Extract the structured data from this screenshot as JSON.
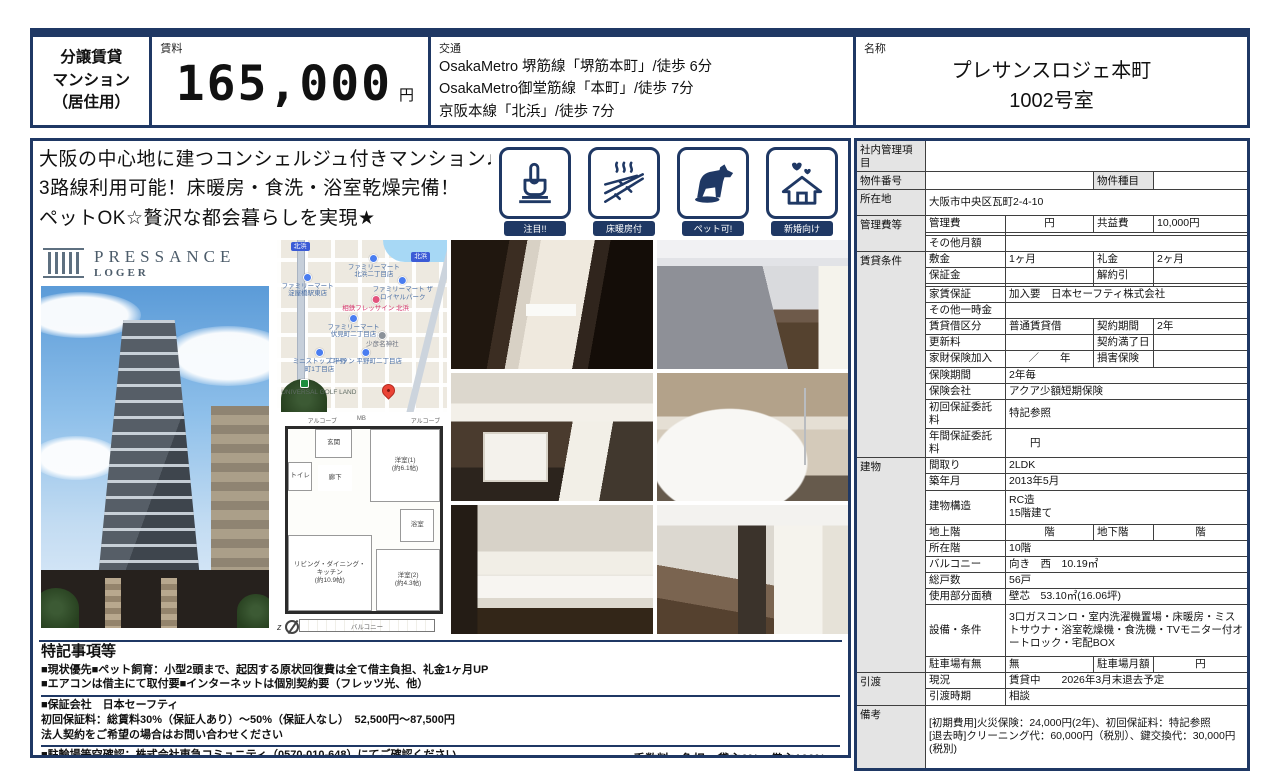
{
  "colors": {
    "navy": "#1f3864",
    "label_bg": "#e4e4e4",
    "pin_red": "#ea4335",
    "poi_blue": "#4a7df0"
  },
  "header": {
    "property_type_lines": [
      "分譲賃貸",
      "マンション",
      "（居住用）"
    ],
    "rent_label": "賃料",
    "rent_value": "165,000",
    "rent_unit": "円",
    "transit_label": "交通",
    "transit_lines": [
      "OsakaMetro 堺筋線「堺筋本町」/徒歩 6分",
      "OsakaMetro御堂筋線「本町」/徒歩 7分",
      "京阪本線「北浜」/徒歩 7分"
    ],
    "name_label": "名称",
    "name_lines": [
      "プレサンスロジェ本町",
      "1002号室"
    ]
  },
  "catch_copy_lines": [
    "大阪の中心地に建つコンシェルジュ付きマンション♪",
    "3路線利用可能！床暖房・食洗・浴室乾燥完備！",
    "ペットOK☆贅沢な都会暮らしを実現★"
  ],
  "features": {
    "items": [
      {
        "label": "注目!!"
      },
      {
        "label": "床暖房付"
      },
      {
        "label": "ペット可!"
      },
      {
        "label": "新婚向け"
      }
    ]
  },
  "logo": {
    "brand": "PRESSANCE",
    "sub": "LOGER"
  },
  "map": {
    "station_labels": [
      "北浜",
      "北浜"
    ],
    "pois": [
      {
        "n": "ファミリーマート\n北浜二丁目店",
        "x": 57,
        "y": 8,
        "c": "blue"
      },
      {
        "n": "ファミリーマート\n淀屋橋駅東店",
        "x": 18,
        "y": 19,
        "c": "blue"
      },
      {
        "n": "ファミリーマート ザ\nロイヤルパーク",
        "x": 74,
        "y": 21,
        "c": "blue"
      },
      {
        "n": "相鉄フレッサイン 北浜",
        "x": 58,
        "y": 32,
        "c": "pink"
      },
      {
        "n": "ファミリーマート\n伏見町二丁目店",
        "x": 45,
        "y": 43,
        "c": "blue"
      },
      {
        "n": "少彦名神社",
        "x": 62,
        "y": 53,
        "c": "gray"
      },
      {
        "n": "ミニストップ 平野\n町1丁目店",
        "x": 25,
        "y": 63,
        "c": "blue"
      },
      {
        "n": "ローソン 平野町二丁目店",
        "x": 52,
        "y": 63,
        "c": "blue"
      },
      {
        "n": "UNIVERSAL GOLF LAND",
        "x": 16,
        "y": 81,
        "c": "green"
      }
    ]
  },
  "floorplan": {
    "alcove_left": "アルコーブ",
    "mb": "MB",
    "alcove_right": "アルコーブ",
    "entrance": "玄関",
    "hall": "廊下",
    "toilet": "トイレ",
    "bath": "浴室",
    "room1": "洋室(1)",
    "room1_size": "(約6.1帖)",
    "ldk": "リビング・ダイニング・キッチン",
    "ldk_size": "(約10.9帖)",
    "room2": "洋室(2)",
    "room2_size": "(約4.3帖)",
    "balcony": "バルコニー",
    "compass": "z"
  },
  "notes": {
    "title": "特記事項等",
    "block1": [
      "■現状優先■ペット飼育：小型2頭まで、起因する原状回復費は全て借主負担、礼金1ヶ月UP",
      "■エアコンは借主にて取付要■インターネットは個別契約要（フレッツ光、他）"
    ],
    "block2": [
      "■保証会社　日本セーフティ",
      "初回保証料：総賃料30%（保証人あり）～50%（保証人なし）　52,500円～87,500円",
      "法人契約をご希望の場合はお問い合わせください"
    ],
    "block3": [
      "■駐輪場等空確認：株式会社東急コミュニティ（0570-010-648）にてご確認ください",
      "■短期解約違約金：半年以内　総賃料2ヶ月、1年以内　総賃料1ヶ月"
    ],
    "fees": [
      "■手数料　負担：貸主0%　借主100%",
      "分配：元付0%　客付100%"
    ]
  },
  "table": {
    "rows": [
      {
        "cells": [
          {
            "t": "社内管理項目",
            "k": "g"
          },
          {
            "t": "",
            "c": 4
          }
        ]
      },
      {
        "cells": [
          {
            "t": "物件番号",
            "k": "g"
          },
          {
            "t": "",
            "c": 2
          },
          {
            "t": "物件種目",
            "k": "g"
          },
          {
            "t": ""
          }
        ]
      },
      {
        "h": 26,
        "cells": [
          {
            "t": "所在地",
            "k": "g"
          },
          {
            "t": "大阪市中央区瓦町2-4-10",
            "c": 4
          }
        ]
      },
      {
        "cells": [
          {
            "t": "管理費等",
            "k": "g",
            "r": 3
          },
          {
            "t": "管理費"
          },
          {
            "t": "円",
            "k": "ctr"
          },
          {
            "t": "共益費"
          },
          {
            "t": "10,000円"
          }
        ]
      },
      {
        "cells": [
          {
            "t": ""
          },
          {
            "t": "",
            "c": 3
          }
        ]
      },
      {
        "cells": [
          {
            "t": "その他月額"
          },
          {
            "t": "",
            "c": 3
          }
        ]
      },
      {
        "cells": [
          {
            "t": "賃貸条件",
            "k": "g",
            "r": 12
          },
          {
            "t": "敷金"
          },
          {
            "t": "1ヶ月"
          },
          {
            "t": "礼金"
          },
          {
            "t": "2ヶ月"
          }
        ]
      },
      {
        "cells": [
          {
            "t": "保証金"
          },
          {
            "t": ""
          },
          {
            "t": "解約引"
          },
          {
            "t": ""
          }
        ]
      },
      {
        "cells": [
          {
            "t": ""
          },
          {
            "t": ""
          },
          {
            "t": ""
          },
          {
            "t": ""
          }
        ]
      },
      {
        "cells": [
          {
            "t": "家賃保証"
          },
          {
            "t": "加入要　日本セーフティ株式会社",
            "c": 3
          }
        ]
      },
      {
        "cells": [
          {
            "t": "その他一時金"
          },
          {
            "t": "",
            "c": 3
          }
        ]
      },
      {
        "cells": [
          {
            "t": "賃貸借区分"
          },
          {
            "t": "普通賃貸借"
          },
          {
            "t": "契約期間"
          },
          {
            "t": "2年"
          }
        ]
      },
      {
        "cells": [
          {
            "t": "更新料"
          },
          {
            "t": ""
          },
          {
            "t": "契約満了日"
          },
          {
            "t": ""
          }
        ]
      },
      {
        "cells": [
          {
            "t": "家財保険加入"
          },
          {
            "t": "／　　年",
            "k": "ctr"
          },
          {
            "t": "損害保険"
          },
          {
            "t": ""
          }
        ]
      },
      {
        "cells": [
          {
            "t": "保険期間"
          },
          {
            "t": "2年毎",
            "c": 3
          }
        ]
      },
      {
        "cells": [
          {
            "t": "保険会社"
          },
          {
            "t": "アクア少額短期保険",
            "c": 3
          }
        ]
      },
      {
        "cells": [
          {
            "t": "初回保証委託料"
          },
          {
            "t": "特記参照",
            "c": 3
          }
        ]
      },
      {
        "cells": [
          {
            "t": "年間保証委託料"
          },
          {
            "t": "　　円",
            "c": 3
          }
        ]
      },
      {
        "cells": [
          {
            "t": "建物",
            "k": "g",
            "r": 10
          },
          {
            "t": "間取り"
          },
          {
            "t": "2LDK",
            "c": 3
          }
        ]
      },
      {
        "cells": [
          {
            "t": "築年月"
          },
          {
            "t": "2013年5月",
            "c": 3
          }
        ]
      },
      {
        "h": 34,
        "cells": [
          {
            "t": "建物構造"
          },
          {
            "t": "RC造\n15階建て",
            "c": 3,
            "k": "pre"
          }
        ]
      },
      {
        "cells": [
          {
            "t": "地上階"
          },
          {
            "t": "階",
            "k": "ctr"
          },
          {
            "t": "地下階"
          },
          {
            "t": "階",
            "k": "ctr"
          }
        ]
      },
      {
        "cells": [
          {
            "t": "所在階"
          },
          {
            "t": "10階",
            "c": 3
          }
        ]
      },
      {
        "cells": [
          {
            "t": "バルコニー"
          },
          {
            "t": "向き　西　10.19㎡",
            "c": 3
          }
        ]
      },
      {
        "cells": [
          {
            "t": "総戸数"
          },
          {
            "t": "56戸",
            "c": 3
          }
        ]
      },
      {
        "cells": [
          {
            "t": "使用部分面積"
          },
          {
            "t": "壁芯　53.10㎡(16.06坪)",
            "c": 3
          }
        ]
      },
      {
        "h": 52,
        "cells": [
          {
            "t": "設備・条件"
          },
          {
            "t": "3口ガスコンロ・室内洗濯機置場・床暖房・ミストサウナ・浴室乾燥機・食洗機・TVモニター付オートロック・宅配BOX",
            "c": 3
          }
        ]
      },
      {
        "cells": [
          {
            "t": "駐車場有無"
          },
          {
            "t": "無"
          },
          {
            "t": "駐車場月額"
          },
          {
            "t": "円",
            "k": "ctr"
          }
        ]
      },
      {
        "cells": [
          {
            "t": "引渡",
            "k": "g",
            "r": 2
          },
          {
            "t": "現況"
          },
          {
            "t": "賃貸中　　2026年3月末退去予定",
            "c": 3
          }
        ]
      },
      {
        "cells": [
          {
            "t": "引渡時期"
          },
          {
            "t": "相談",
            "c": 3
          }
        ]
      },
      {
        "h": 64,
        "cells": [
          {
            "t": "備考",
            "k": "g"
          },
          {
            "t": "[初期費用]火災保険：24,000円(2年)、初回保証料：特記参照\n[退去時]クリーニング代：60,000円（税別）、鍵交換代：30,000円(税別)",
            "c": 4,
            "k": "pre"
          }
        ]
      }
    ]
  }
}
